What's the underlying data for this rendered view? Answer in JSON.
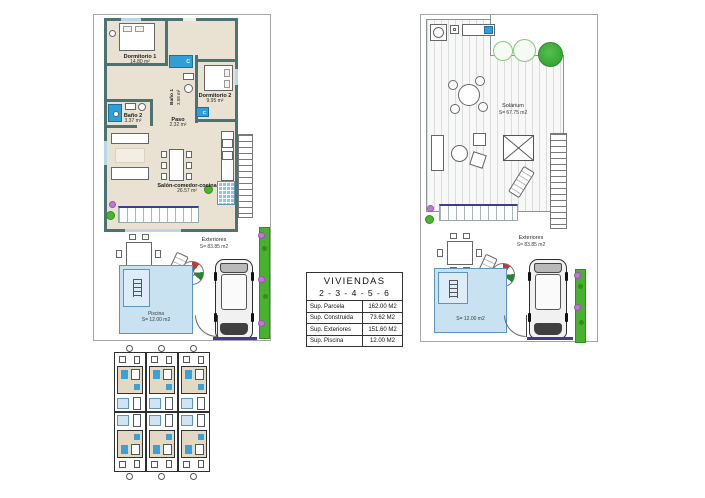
{
  "colors": {
    "wall": "#4d7272",
    "interior_floor": "#e9e1d1",
    "fixture_blue": "#2f9fd6",
    "terrace_edge_navy": "#3c3e8f",
    "pool_fill": "#c8e2f2",
    "pool_border": "#5e93bc",
    "hedge_green": "#47b22b",
    "flower_purple": "#bd7ad1"
  },
  "ground_plan": {
    "rooms": {
      "dormitorio1": {
        "name": "Dormitorio 1",
        "area": "14.80 m²"
      },
      "bano1": {
        "name": "Baño 1",
        "area": "3.58 m²"
      },
      "dormitorio2": {
        "name": "Dormitorio 2",
        "area": "9.95 m²"
      },
      "bano2": {
        "name": "Baño 2",
        "area": "3.37 m²"
      },
      "paso": {
        "name": "Paso",
        "area": "2.32 m²"
      },
      "salon": {
        "name": "Salón-comedor-cocina",
        "area": "26.57 m²"
      }
    },
    "closet_label": "C",
    "exterior": {
      "name": "Exteriores",
      "area": "S= 83.85 m2"
    },
    "pool": {
      "name": "Piscina",
      "area": "S= 12.00 m2"
    }
  },
  "upper_plan": {
    "solarium": {
      "name": "Solárium",
      "area": "S= 67.75 m2"
    },
    "exterior": {
      "name": "Exteriores",
      "area": "S= 83.85 m2"
    },
    "pool": {
      "area": "S= 12.00 m2"
    }
  },
  "summary_table": {
    "title": "VIVIENDAS",
    "subtitle": "2 - 3 - 4 - 5 - 6",
    "rows": [
      {
        "label": "Sup. Parcela",
        "value": "162.00 M2"
      },
      {
        "label": "Sup. Construida",
        "value": "73.62 M2"
      },
      {
        "label": "Sup. Exteriores",
        "value": "151.60 M2"
      },
      {
        "label": "Sup. Piscina",
        "value": "12.00 M2"
      }
    ]
  }
}
